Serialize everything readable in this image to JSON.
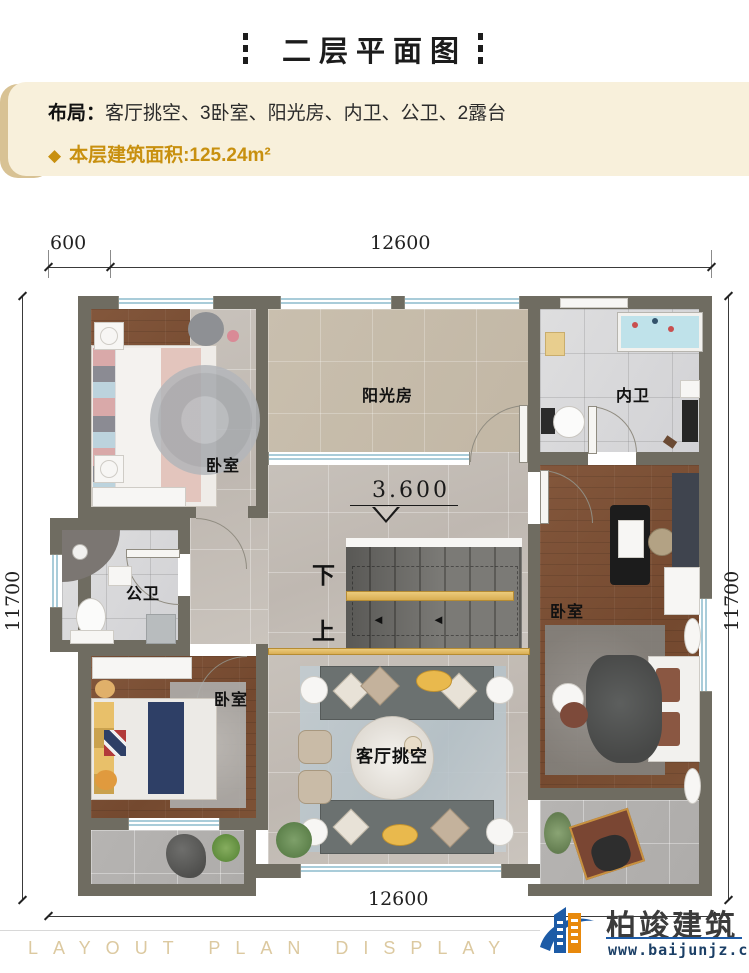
{
  "header": {
    "title": "二层平面图"
  },
  "info_box": {
    "layout_label": "布局：",
    "layout_value": "客厅挑空、3卧室、阳光房、内卫、公卫、2露台",
    "area_bullet": "◆",
    "area_text": "本层建筑面积:125.24m²"
  },
  "plan": {
    "level_annotation": "3.600",
    "dimensions": {
      "top_offset": "600",
      "top_main": "12600",
      "left": "11700",
      "right": "11700",
      "bottom": "12600"
    },
    "rooms": [
      {
        "id": "bedroom-top-left",
        "label": "卧室"
      },
      {
        "id": "sunroom",
        "label": "阳光房"
      },
      {
        "id": "ensuite-bath",
        "label": "内卫"
      },
      {
        "id": "public-bath",
        "label": "公卫"
      },
      {
        "id": "bedroom-right",
        "label": "卧室"
      },
      {
        "id": "bedroom-bottom-left",
        "label": "卧室"
      },
      {
        "id": "living-void",
        "label": "客厅挑空"
      }
    ],
    "stairs": {
      "down_label": "下",
      "up_label": "上",
      "arrow_left": "◄",
      "arrow_right": "►"
    }
  },
  "footer": {
    "watermark": "LAYOUT PLAN DISPLAY LAYOUT PLAN",
    "brand": "柏竣建筑",
    "site": "www.baijunjz.com"
  },
  "colors": {
    "accent_gold": "#c8900f",
    "info_bg": "#f8f0db",
    "wall": "#6f6c61",
    "window_blue": "#a9ccd9",
    "wood_floor": "#7c5138",
    "logo_blue": "#1d5ba6",
    "logo_orange": "#e8890c"
  }
}
